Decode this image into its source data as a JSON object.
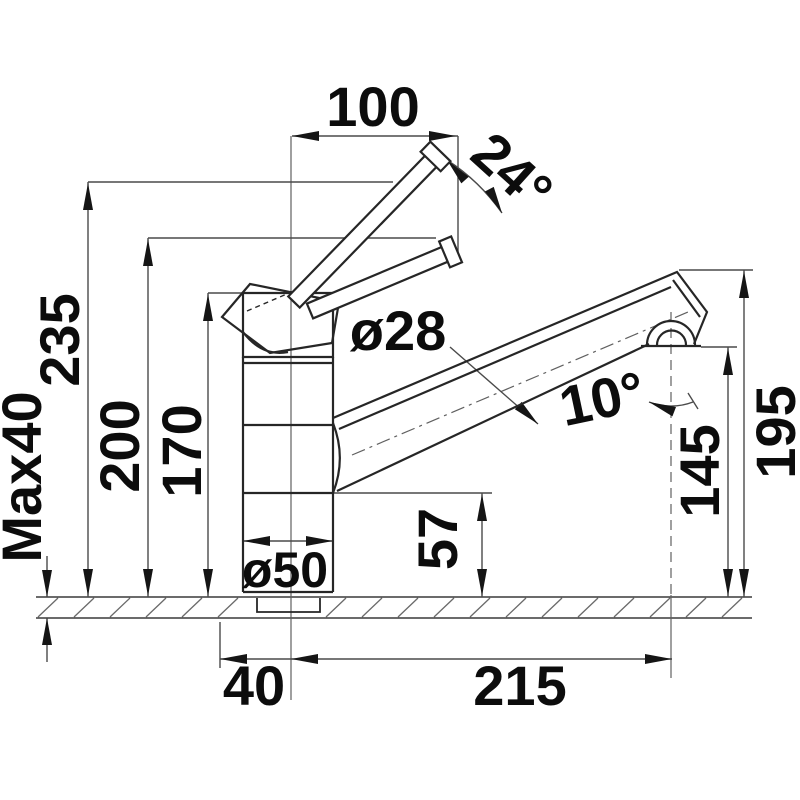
{
  "drawing": {
    "type": "kitchen faucet technical dimension drawing",
    "unit": "mm",
    "labels": {
      "lever_width": "100",
      "lever_angle": "24°",
      "total_height": "235",
      "lever_height": "200",
      "body_height": "170",
      "max_mounting_thickness": "Max40",
      "spout_tube_diameter": "ø28",
      "spout_tilt_angle": "10°",
      "aerator_height": "145",
      "spout_height": "195",
      "base_height": "57",
      "base_diameter": "ø50",
      "hole_offset": "40",
      "spout_reach": "215"
    },
    "colors": {
      "background": "#ffffff",
      "object_line": "#262626",
      "dimension_line": "#4a4a4a",
      "hatch_line": "#6a6a6a",
      "text": "#0c0c0c"
    }
  }
}
